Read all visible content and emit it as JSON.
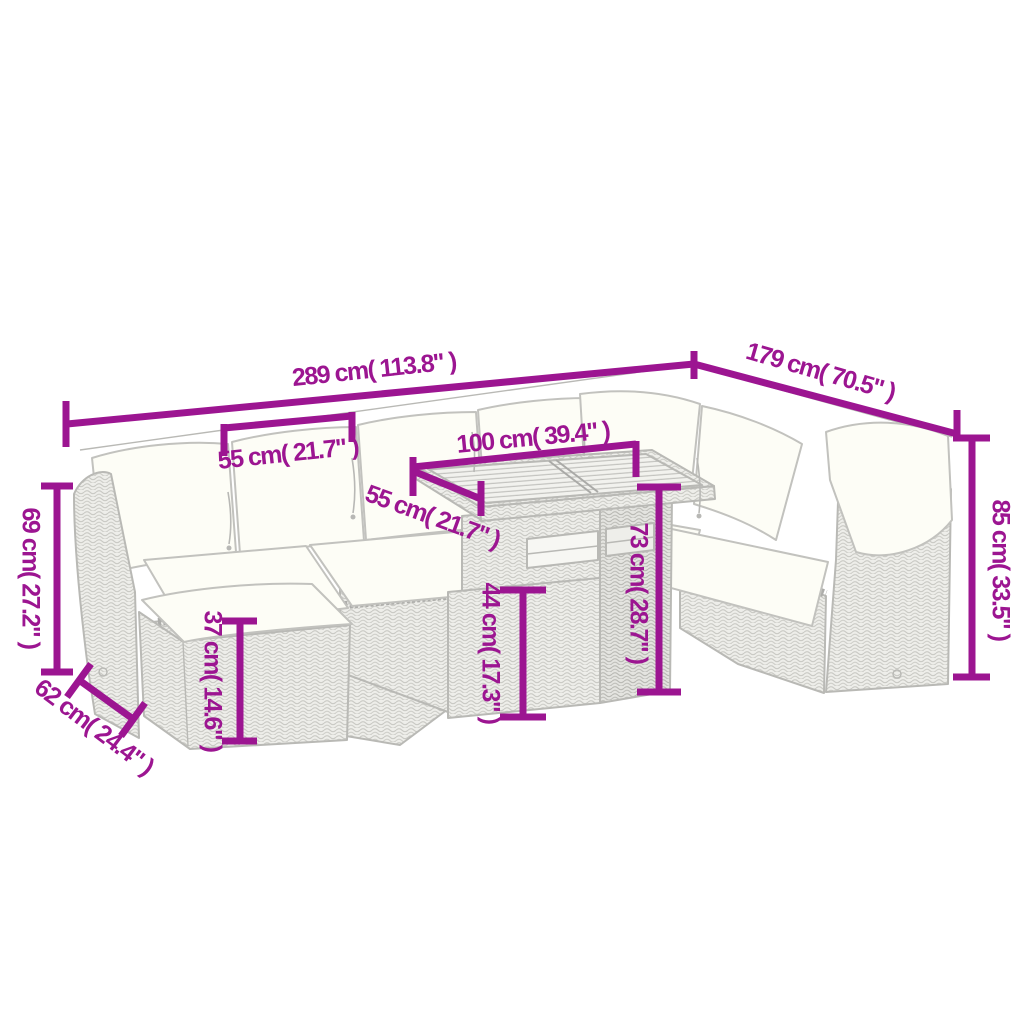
{
  "meta": {
    "subject": "Garden rattan lounge set with table and ottoman — product dimension diagram",
    "background": "#ffffff"
  },
  "colors": {
    "dimension": "#9C1591",
    "furniture_outline": "#b9b9b5",
    "cushion_fill": "#fdfdf6",
    "rattan_fill": "#eeeeea"
  },
  "dimensions": {
    "total_width": {
      "label": "289 cm( 113.8\" )",
      "cm": 289,
      "inch": 113.8
    },
    "total_depth": {
      "label": "179 cm( 70.5\" )",
      "cm": 179,
      "inch": 70.5
    },
    "seat_width": {
      "label": "55 cm( 21.7\" )",
      "cm": 55,
      "inch": 21.7
    },
    "table_length": {
      "label": "100 cm( 39.4\" )",
      "cm": 100,
      "inch": 39.4
    },
    "table_depth": {
      "label": "55 cm( 21.7\" )",
      "cm": 55,
      "inch": 21.7
    },
    "armrest_height": {
      "label": "69 cm( 27.2\" )",
      "cm": 69,
      "inch": 27.2
    },
    "seat_depth": {
      "label": "62 cm( 24.4\" )",
      "cm": 62,
      "inch": 24.4
    },
    "ottoman_height": {
      "label": "37 cm( 14.6\" )",
      "cm": 37,
      "inch": 14.6
    },
    "shelf_height": {
      "label": "44 cm( 17.3\" )",
      "cm": 44,
      "inch": 17.3
    },
    "table_height": {
      "label": "73 cm( 28.7\" )",
      "cm": 73,
      "inch": 28.7
    },
    "backrest_height": {
      "label": "85 cm( 33.5\" )",
      "cm": 85,
      "inch": 33.5
    }
  }
}
